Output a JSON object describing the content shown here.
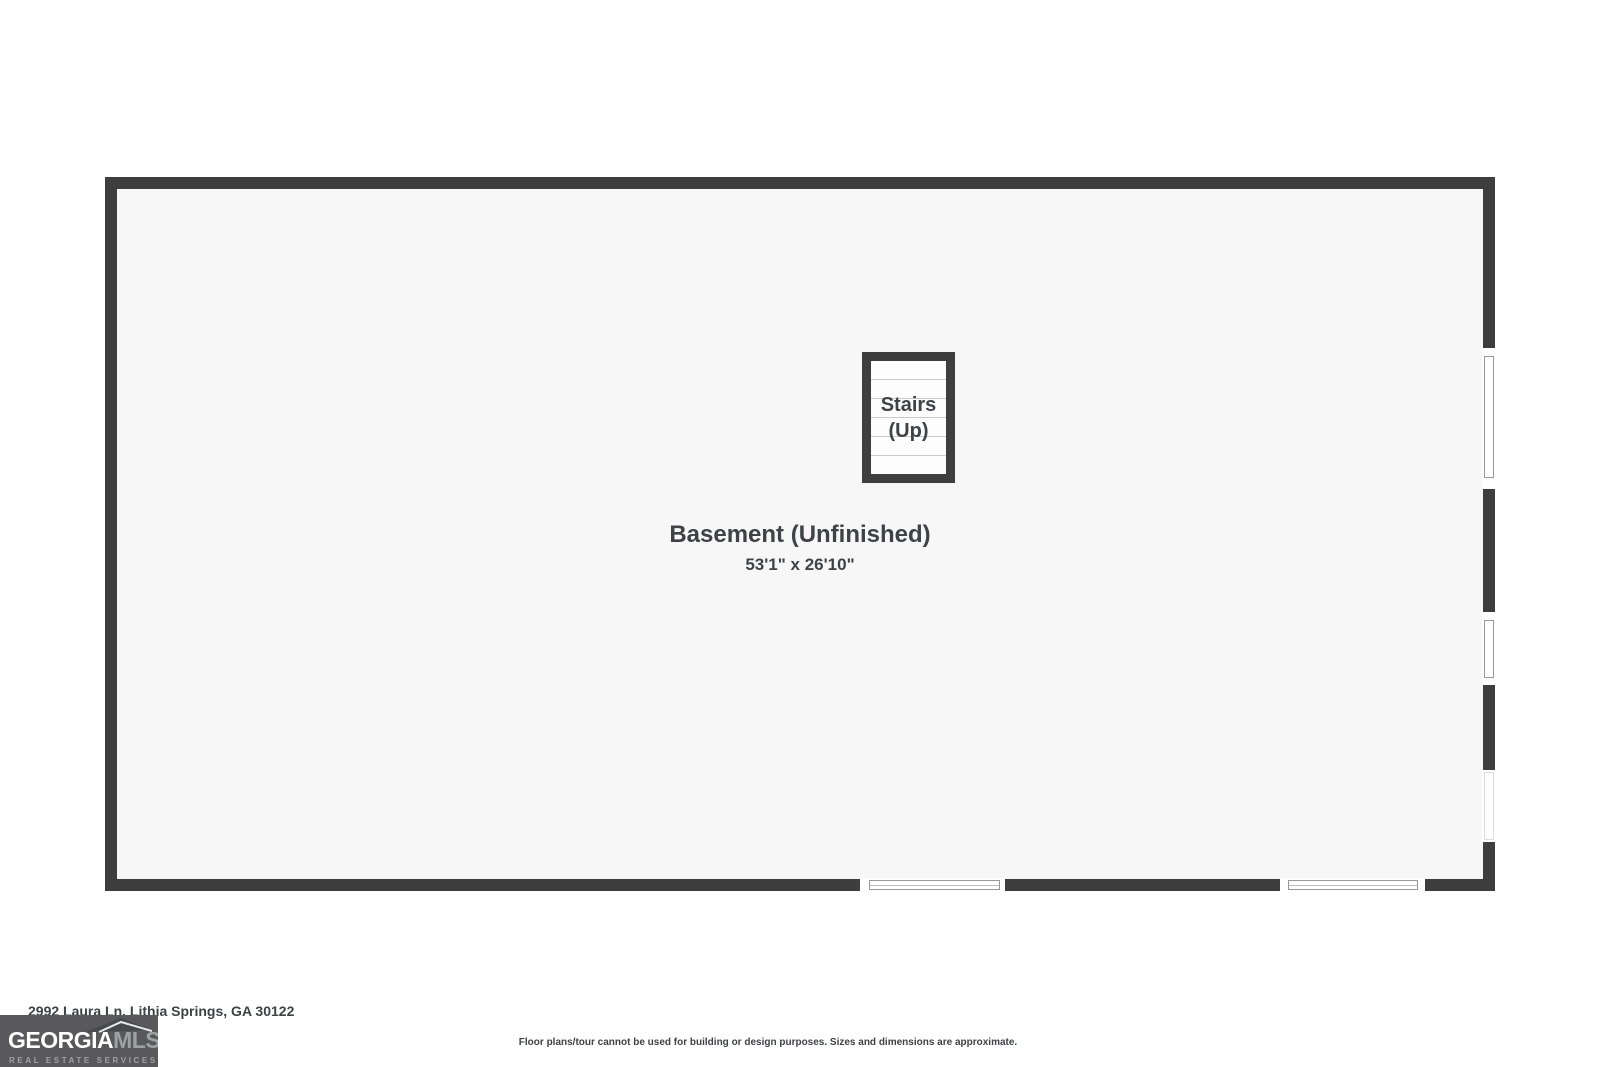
{
  "plan": {
    "room": {
      "name": "Basement (Unfinished)",
      "dimensions": "53'1\" x 26'10\""
    },
    "stairs": {
      "line1": "Stairs",
      "line2": "(Up)"
    }
  },
  "footer": {
    "address": "2992 Laura Ln, Lithia Springs, GA 30122",
    "disclaimer": "Floor plans/tour cannot be used for building or design purposes. Sizes and dimensions are approximate."
  },
  "logo": {
    "brand_primary": "GEORGIA",
    "brand_secondary": "MLS",
    "tagline": "REAL ESTATE SERVICES"
  },
  "colors": {
    "wall": "#3e3e3e",
    "floor": "#f7f7f7",
    "ink": "#3f4347",
    "logo-bg": "#59595b",
    "logo-primary": "#ffffff",
    "logo-secondary": "#a0a1a3",
    "frame-line": "#999999"
  }
}
